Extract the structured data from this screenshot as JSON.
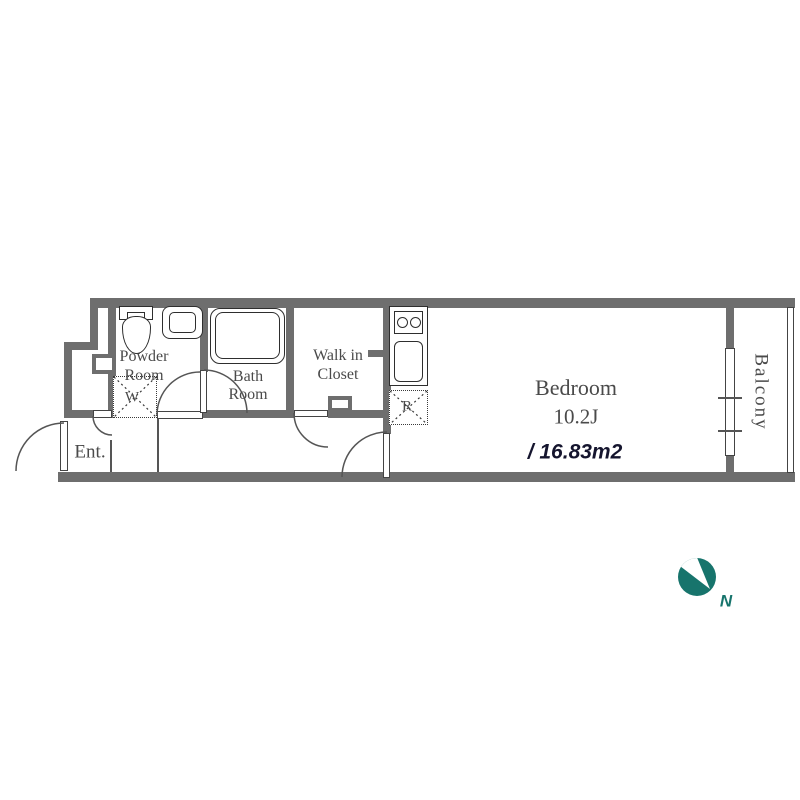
{
  "floorplan": {
    "rooms": {
      "entrance": {
        "label": "Ent."
      },
      "powder_room": {
        "name_line1": "Powder",
        "name_line2": "Room",
        "washer_label": "W"
      },
      "bath_room": {
        "name_line1": "Bath",
        "name_line2": "Room"
      },
      "walk_in_closet": {
        "name_line1": "Walk in",
        "name_line2": "Closet"
      },
      "kitchen": {
        "refrigerator_label": "R"
      },
      "bedroom": {
        "name": "Bedroom",
        "size_tatami": "10.2J",
        "area_sqm": "/ 16.83m2"
      },
      "balcony": {
        "label": "Balcony"
      }
    },
    "compass": {
      "north_label": "N"
    },
    "colors": {
      "wall_gray": "#6e6e6e",
      "label_text": "#4a4a4a",
      "area_text": "#15152e",
      "compass_teal": "#17746c"
    }
  }
}
